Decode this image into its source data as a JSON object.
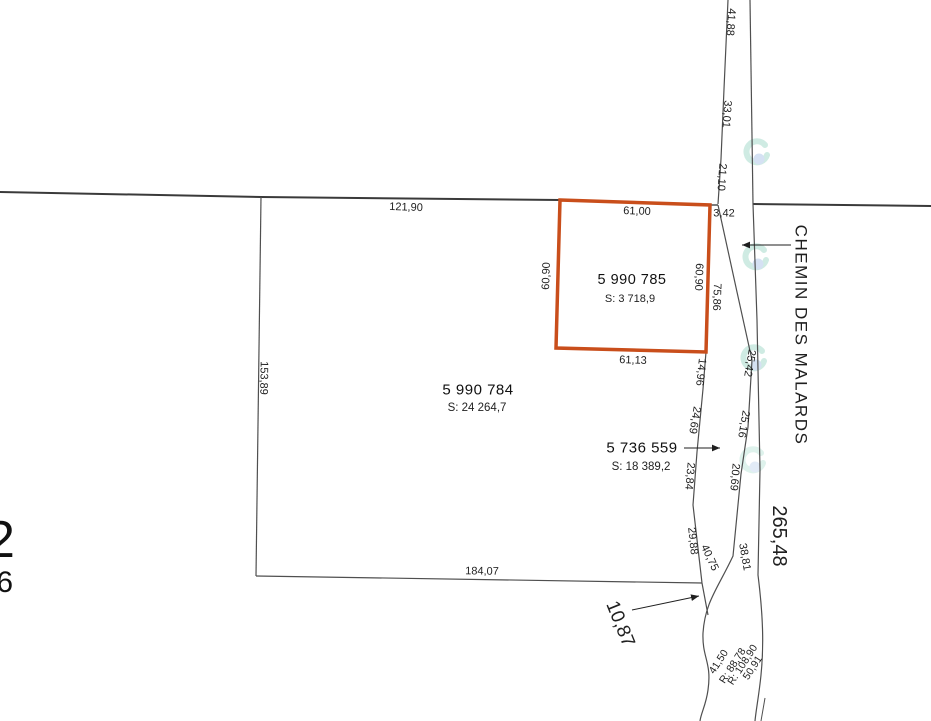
{
  "map": {
    "road": {
      "name": "CHEMIN DES MALARDS",
      "name_pos": {
        "x": 801,
        "y": 335,
        "r": 90,
        "s": 17,
        "ls": 1.5
      },
      "total_length": "265,48",
      "total_pos": {
        "x": 779,
        "y": 536,
        "r": 90,
        "s": 20
      }
    },
    "parcels": [
      {
        "lot": "5 990 784",
        "area": "S: 24 264,7",
        "nx": 478,
        "ny": 390,
        "ns": 15,
        "ax": 477,
        "ay": 408,
        "as": 11.5
      },
      {
        "lot": "5 990 785",
        "area": "S: 3 718,9",
        "nx": 632,
        "ny": 280,
        "ns": 14.5,
        "ax": 630,
        "ay": 299,
        "as": 11
      },
      {
        "lot": "5 736 559",
        "area": "S: 18 389,2",
        "nx": 642,
        "ny": 448,
        "ns": 15,
        "ax": 641,
        "ay": 467,
        "as": 11.5
      }
    ],
    "dimensions": [
      {
        "t": "121,90",
        "x": 406,
        "y": 208,
        "r": 2,
        "s": 11
      },
      {
        "t": "61,00",
        "x": 637,
        "y": 212,
        "r": 2,
        "s": 11
      },
      {
        "t": "3,42",
        "x": 724,
        "y": 214,
        "r": 0,
        "s": 11
      },
      {
        "t": "41,88",
        "x": 730,
        "y": 22,
        "r": 94,
        "s": 11
      },
      {
        "t": "33,01",
        "x": 726,
        "y": 114,
        "r": 94,
        "s": 11
      },
      {
        "t": "21,10",
        "x": 721,
        "y": 177,
        "r": 94,
        "s": 11
      },
      {
        "t": "60,90",
        "x": 547,
        "y": 276,
        "r": -88,
        "s": 11
      },
      {
        "t": "60,90",
        "x": 698,
        "y": 277,
        "r": 92,
        "s": 11
      },
      {
        "t": "75,86",
        "x": 716,
        "y": 297,
        "r": 92,
        "s": 11
      },
      {
        "t": "61,13",
        "x": 633,
        "y": 361,
        "r": 2,
        "s": 11
      },
      {
        "t": "14,96",
        "x": 700,
        "y": 372,
        "r": 96,
        "s": 11
      },
      {
        "t": "153,89",
        "x": 263,
        "y": 378,
        "r": 91,
        "s": 11
      },
      {
        "t": "25,42",
        "x": 749,
        "y": 363,
        "r": 100,
        "s": 11
      },
      {
        "t": "24,69",
        "x": 694,
        "y": 420,
        "r": 100,
        "s": 11
      },
      {
        "t": "25,16",
        "x": 743,
        "y": 424,
        "r": 100,
        "s": 11
      },
      {
        "t": "20,69",
        "x": 734,
        "y": 477,
        "r": 95,
        "s": 11
      },
      {
        "t": "23,84",
        "x": 689,
        "y": 476,
        "r": 95,
        "s": 11
      },
      {
        "t": "29,88",
        "x": 692,
        "y": 541,
        "r": 84,
        "s": 11
      },
      {
        "t": "40,75",
        "x": 709,
        "y": 558,
        "r": 65,
        "s": 11
      },
      {
        "t": "38,81",
        "x": 744,
        "y": 557,
        "r": 80,
        "s": 11
      },
      {
        "t": "184,07",
        "x": 482,
        "y": 572,
        "r": 1,
        "s": 11
      },
      {
        "t": "10,87",
        "x": 620,
        "y": 624,
        "r": 68,
        "s": 19
      },
      {
        "t": "41,50",
        "x": 719,
        "y": 662,
        "r": -57,
        "s": 10.5
      },
      {
        "t": "R: 88,78",
        "x": 733,
        "y": 666,
        "r": -57,
        "s": 10.5
      },
      {
        "t": "R: 108,90",
        "x": 743,
        "y": 665,
        "r": -57,
        "s": 10.5
      },
      {
        "t": "50,91",
        "x": 753,
        "y": 668,
        "r": -57,
        "s": 10.5
      }
    ],
    "clipped_labels": [
      {
        "t": "2",
        "x": -14,
        "y": 514,
        "s": 52
      },
      {
        "t": ",6",
        "x": -12,
        "y": 568,
        "s": 30
      }
    ],
    "colors": {
      "highlight": "#c94e1b",
      "line": "#4f4f4f",
      "boundary": "#3a3a3a",
      "text": "#1f1f1f",
      "watermark_teal": "#a9dccd",
      "watermark_blue": "#b4c9ea"
    }
  }
}
